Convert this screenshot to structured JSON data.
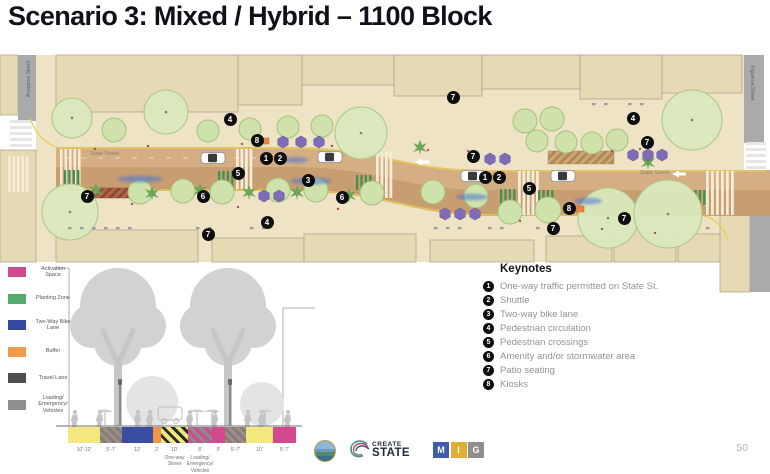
{
  "title": "Scenario 3: Mixed / Hybrid – 1100 Block",
  "page_number": "50",
  "plan": {
    "street_labels": {
      "left_vertical": "Anapamu Street",
      "right_vertical": "Figueroa Street",
      "state_left": "State Street",
      "state_right": "State Street"
    },
    "markers": [
      {
        "n": "7",
        "x": 453,
        "y": 97
      },
      {
        "n": "4",
        "x": 230,
        "y": 119
      },
      {
        "n": "8",
        "x": 257,
        "y": 140
      },
      {
        "n": "1",
        "x": 266,
        "y": 158
      },
      {
        "n": "2",
        "x": 280,
        "y": 158
      },
      {
        "n": "7",
        "x": 473,
        "y": 156
      },
      {
        "n": "4",
        "x": 633,
        "y": 118
      },
      {
        "n": "7",
        "x": 647,
        "y": 142
      },
      {
        "n": "5",
        "x": 238,
        "y": 173
      },
      {
        "n": "3",
        "x": 308,
        "y": 180
      },
      {
        "n": "1",
        "x": 485,
        "y": 177
      },
      {
        "n": "2",
        "x": 499,
        "y": 177
      },
      {
        "n": "5",
        "x": 529,
        "y": 188
      },
      {
        "n": "6",
        "x": 203,
        "y": 196
      },
      {
        "n": "6",
        "x": 342,
        "y": 197
      },
      {
        "n": "7",
        "x": 87,
        "y": 196
      },
      {
        "n": "8",
        "x": 569,
        "y": 208
      },
      {
        "n": "7",
        "x": 624,
        "y": 218
      },
      {
        "n": "4",
        "x": 267,
        "y": 222
      },
      {
        "n": "7",
        "x": 553,
        "y": 228
      },
      {
        "n": "7",
        "x": 208,
        "y": 234
      }
    ]
  },
  "legend": {
    "items": [
      {
        "label": "Activation Space",
        "color": "#cf4b8e"
      },
      {
        "label": "Planting Zone",
        "color": "#54ab6d"
      },
      {
        "label": "Two-Way Bike Lane",
        "color": "#34489f"
      },
      {
        "label": "Buffer",
        "color": "#f09a4c"
      },
      {
        "label": "Travel Lane",
        "color": "#4f4f51"
      },
      {
        "label": "Loading/ Emergency/ Vehicles",
        "color": "#8f8f91"
      }
    ]
  },
  "keynotes": {
    "heading": "Keynotes",
    "items": [
      {
        "n": "1",
        "label": "One-way traffic permitted on State St."
      },
      {
        "n": "2",
        "label": "Shuttle"
      },
      {
        "n": "3",
        "label": "Two-way bike lane"
      },
      {
        "n": "4",
        "label": "Pedestrian circulation"
      },
      {
        "n": "5",
        "label": "Pedestrian crossings"
      },
      {
        "n": "6",
        "label": "Amenity and/or stormwater area"
      },
      {
        "n": "7",
        "label": "Patio seating"
      },
      {
        "n": "8",
        "label": "Kiosks"
      }
    ]
  },
  "section": {
    "segments": [
      {
        "dim": "10'-12'",
        "style": "yellow",
        "color": "#f2e87e",
        "w": 32,
        "sub": ""
      },
      {
        "dim": "5'-7'",
        "style": "gray-hatch",
        "color": "",
        "w": 22,
        "sub": ""
      },
      {
        "dim": "12'",
        "style": "blue",
        "color": "#3a4da3",
        "w": 31,
        "sub": ""
      },
      {
        "dim": "2'",
        "style": "orange",
        "color": "#f0964b",
        "w": 8,
        "sub": ""
      },
      {
        "dim": "10'",
        "style": "oneway-hatch",
        "color": "",
        "w": 27,
        "sub": "One-way Street"
      },
      {
        "dim": "8'",
        "style": "loading-hatch",
        "color": "",
        "w": 24,
        "sub": "Loading/ Emergency/ Vehicles"
      },
      {
        "dim": "5'",
        "style": "pink",
        "color": "#d24a8d",
        "w": 13,
        "sub": ""
      },
      {
        "dim": "5'-7'",
        "style": "gray-hatch",
        "color": "",
        "w": 21,
        "sub": ""
      },
      {
        "dim": "10'",
        "style": "yellow",
        "color": "#f2e87e",
        "w": 27,
        "sub": ""
      },
      {
        "dim": "5'-7'",
        "style": "pink",
        "color": "#d24a8d",
        "w": 23,
        "sub": ""
      }
    ]
  },
  "logos": {
    "create_state_top": "CREATE",
    "create_state_bottom": "STATE",
    "mig": [
      "M",
      "I",
      "G"
    ],
    "mig_colors": [
      "#3d5ea8",
      "#dfae33",
      "#8f8f8f"
    ]
  }
}
